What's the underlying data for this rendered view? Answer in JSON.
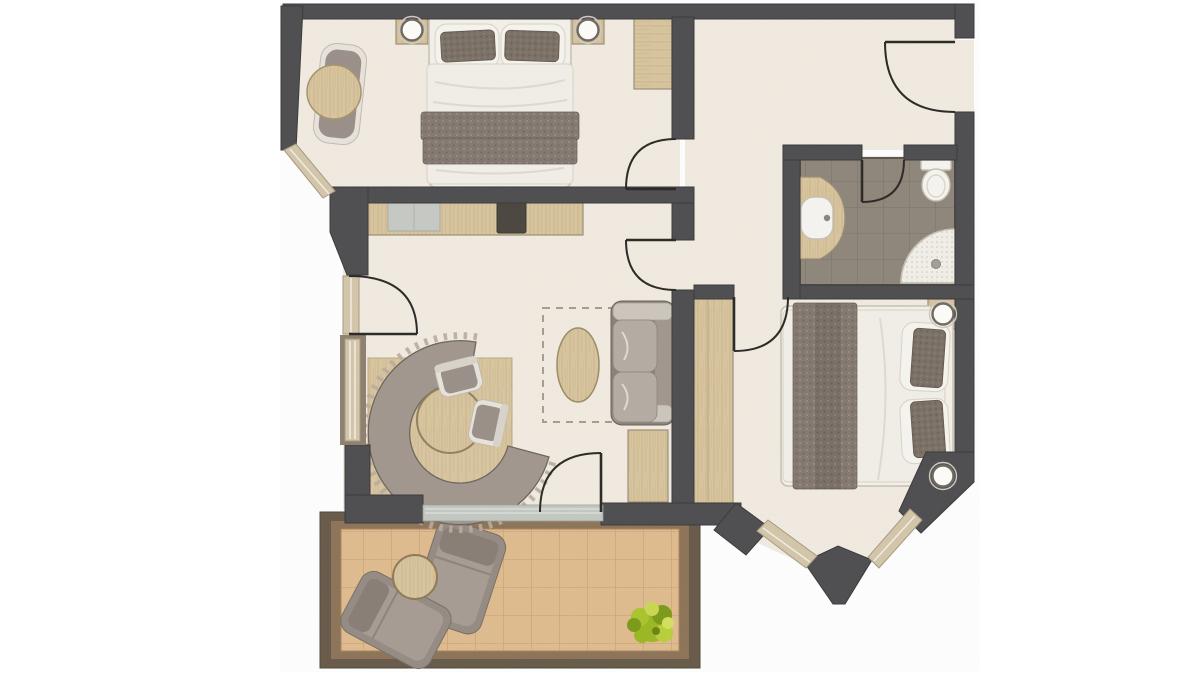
{
  "meta": {
    "type": "apartment-floor-plan",
    "view": "top-down architectural rendering",
    "canvas": {
      "width": 1200,
      "height": 675
    },
    "visible_text": []
  },
  "palette": {
    "wall": "#4d4d50",
    "wallStroke": "#39393c",
    "floor": "#f1ebe1",
    "woodBase": "#d8c59e",
    "woodGrain": "#c9b287",
    "woodEdge": "#9c8f76",
    "windowFrame": "#d3c6aa",
    "windowEdge": "#a79a80",
    "windowGlassLine": "#f2ede2",
    "door": "#2e2c29",
    "glassTrack": "#c3c8c2",
    "bedding": "#f4f1ea",
    "beddingEdge": "#c8c1b4",
    "duvet": "#f2efe8",
    "pillowBase": "#7b7066",
    "blanketBase": "#847970",
    "upholstery": "#9a9089",
    "upholsteryLight": "#b5aca4",
    "trimWhite": "#e8e4dd",
    "sofaBase": "#8a817a",
    "bathTileBase": "#8e867b",
    "bathGrout": "#7a7368",
    "bathInnerEdge": "#5b554d",
    "porcelain": "#f6f5f1",
    "porcelainEdge": "#c6c0b5",
    "balconyFrame": "#675a49",
    "balconyRim": "#8d7458",
    "balconyTileBase": "#e0bc8f",
    "balconyGrout": "#c79e6f",
    "stove": "#4a463f",
    "rugDash": "#a69d8f",
    "benchFill": "#a1978e",
    "plantMain": "#9cb822",
    "plantLight": "#c9d94e",
    "plantDark": "#7d9a16"
  },
  "rooms": [
    {
      "id": "bedroom-1",
      "position": "top-left",
      "furniture": [
        "double-bed",
        "two-dark-pillows",
        "folded-blanket",
        "nightstand-left",
        "nightstand-right",
        "wall-lamp-left",
        "wall-lamp-right",
        "lounge-chair",
        "round-side-table",
        "wardrobe"
      ]
    },
    {
      "id": "entry-hall",
      "position": "top-right",
      "furniture": []
    },
    {
      "id": "bathroom",
      "position": "right",
      "floor": "gray-tiles",
      "furniture": [
        "vanity-with-sink",
        "toilet",
        "corner-shower"
      ]
    },
    {
      "id": "bedroom-2",
      "position": "right",
      "bay": "angled-bay-windows",
      "furniture": [
        "double-bed",
        "two-dark-pillows",
        "folded-blanket",
        "nightstand-top",
        "nightstand-bottom",
        "lamp-top",
        "lamp-bottom",
        "wardrobe"
      ]
    },
    {
      "id": "living-kitchen",
      "position": "center-left",
      "furniture": [
        "kitchen-counter",
        "kitchen-sink",
        "cooktop",
        "dining-mat",
        "round-dining-table",
        "curved-bench",
        "chair",
        "chair",
        "two-seat-sofa",
        "oval-coffee-table",
        "dashed-rug",
        "sideboard"
      ]
    },
    {
      "id": "balcony",
      "position": "bottom",
      "floor": "terracotta-tiles",
      "furniture": [
        "sun-lounger",
        "sun-lounger",
        "round-table",
        "plant"
      ]
    }
  ],
  "openings": {
    "doors": [
      "entry-door",
      "bedroom-1-door",
      "living-room-door",
      "bedroom-2-door",
      "bathroom-door",
      "french-window-door",
      "balcony-door"
    ],
    "windows": [
      "bedroom-1-corner-window",
      "living-left-window",
      "living-left-lower-window",
      "balcony-glazing",
      "bay-window-left",
      "bay-window-right"
    ]
  }
}
